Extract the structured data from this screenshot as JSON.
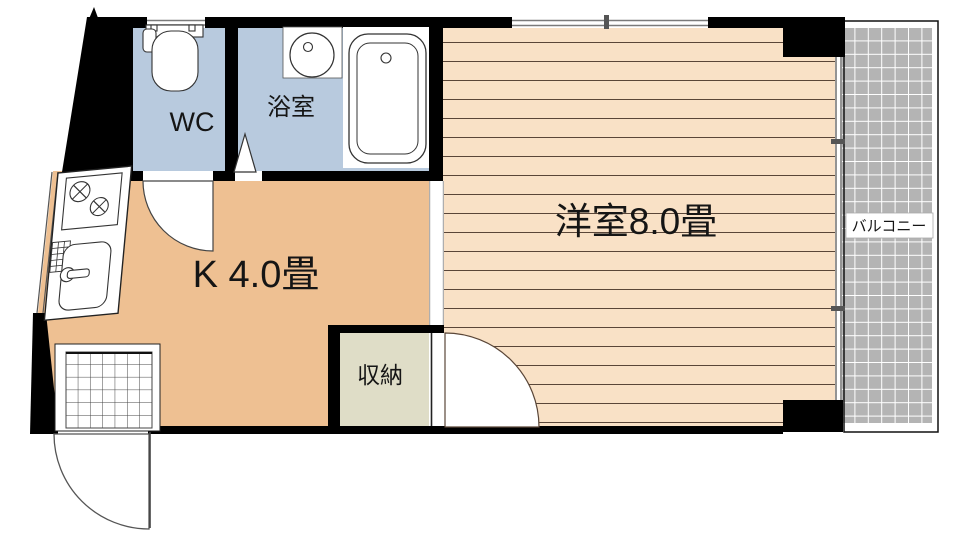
{
  "floorplan": {
    "rooms": {
      "wc": {
        "label": "WC"
      },
      "bathroom": {
        "label": "浴室"
      },
      "kitchen": {
        "label": "K 4.0畳"
      },
      "western_room": {
        "label": "洋室8.0畳"
      },
      "storage": {
        "label": "収納"
      },
      "balcony": {
        "label": "バルコニー"
      }
    },
    "colors": {
      "kitchen_floor": "#eec092",
      "western_room_floor": "#f9e1c6",
      "wet_area_floor": "#b8cade",
      "storage_floor": "#dfddc7",
      "balcony_floor": "#b4b4b4",
      "wall": "#000000",
      "floor_board_line": "#5a4638"
    }
  }
}
